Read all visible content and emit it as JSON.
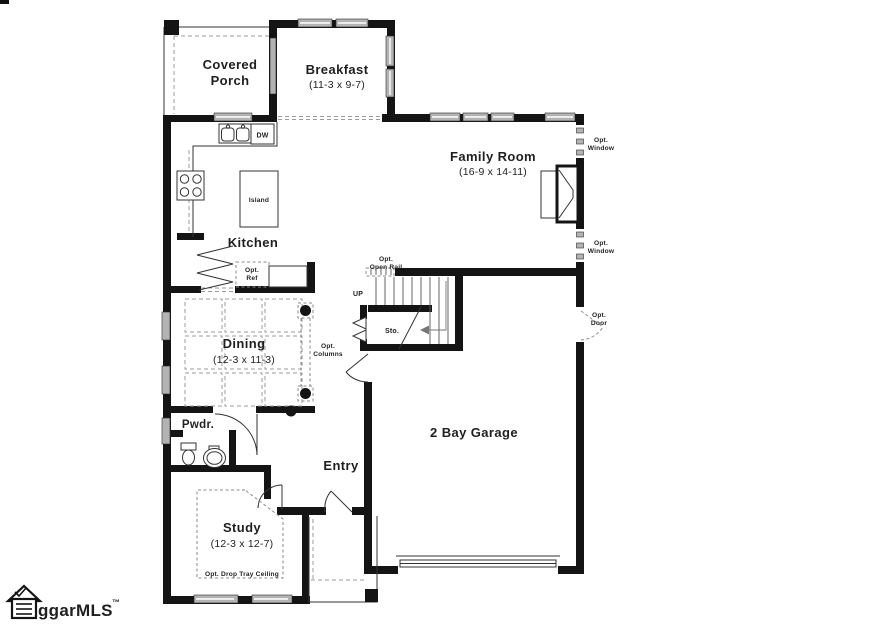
{
  "plan": {
    "rooms": {
      "covered_porch": {
        "line1": "Covered",
        "line2": "Porch"
      },
      "breakfast": {
        "name": "Breakfast",
        "dims": "(11-3 x 9-7)"
      },
      "family_room": {
        "name": "Family Room",
        "dims": "(16-9 x 14-11)"
      },
      "kitchen": {
        "name": "Kitchen"
      },
      "island": {
        "name": "Island"
      },
      "dining": {
        "name": "Dining",
        "dims": "(12-3 x 11-3)"
      },
      "powder": {
        "name": "Pwdr."
      },
      "entry": {
        "name": "Entry"
      },
      "study": {
        "name": "Study",
        "dims": "(12-3 x 12-7)",
        "ceiling_note": "Opt. Drop Tray Ceiling"
      },
      "garage": {
        "name": "2 Bay Garage"
      },
      "storage": {
        "name": "Sto."
      }
    },
    "labels": {
      "up": "UP",
      "dw": "DW",
      "opt_window": {
        "line1": "Opt.",
        "line2": "Window"
      },
      "opt_door": {
        "line1": "Opt.",
        "line2": "Door"
      },
      "opt_open_rail": {
        "line1": "Opt.",
        "line2": "Open Rail"
      },
      "opt_columns": {
        "line1": "Opt.",
        "line2": "Columns"
      },
      "opt_ref": {
        "line1": "Opt.",
        "line2": "Ref"
      }
    },
    "logo": {
      "text": "ggarMLS",
      "tm": "™"
    }
  },
  "colors": {
    "background": "#ffffff",
    "wall": "#141414",
    "window_fill": "#b3b3b3",
    "dashed_line": "#9b9b9b",
    "text": "#1f1f1f"
  }
}
